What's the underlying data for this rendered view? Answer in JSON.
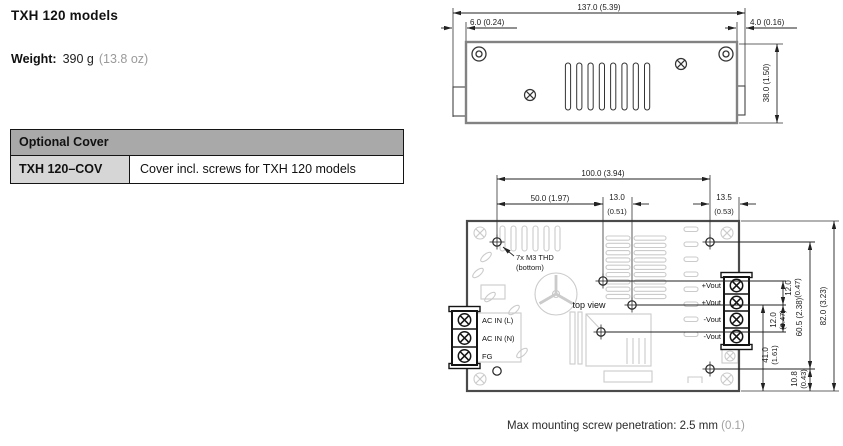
{
  "page": {
    "title": "TXH 120 models"
  },
  "weight": {
    "label": "Weight:",
    "grams": "390 g",
    "ounces": "(13.8 oz)"
  },
  "optional_cover_table": {
    "header": "Optional Cover",
    "row": {
      "model": "TXH 120–COV",
      "description": "Cover incl. screws for TXH 120 models"
    }
  },
  "side_view": {
    "dims": {
      "width_total": "137.0 (5.39)",
      "left_offset": "6.0 (0.24)",
      "right_offset": "4.0 (0.16)",
      "height": "38.0 (1.50)"
    }
  },
  "top_view": {
    "view_label": "top view",
    "thread_note_line1": "7x M3 THD",
    "thread_note_line2": "(bottom)",
    "dims": {
      "w100": "100.0 (3.94)",
      "w50": "50.0 (1.97)",
      "w13_mm": "13.0",
      "w13_in": "(0.51)",
      "w135_mm": "13.5",
      "w135_in": "(0.53)",
      "p12a_mm": "12.0",
      "p12a_in": "(0.47)",
      "p12b_mm": "12.0",
      "p12b_in": "(0.47)",
      "h605": "60.5 (2.38)",
      "h82": "82.0 (3.23)",
      "h41_mm": "41.0",
      "h41_in": "(1.61)",
      "h108_mm": "10.8",
      "h108_in": "(0.43)"
    },
    "terminals_input": [
      "AC IN (L)",
      "AC IN (N)",
      "FG"
    ],
    "terminals_output": [
      "+Vout",
      "+Vout",
      "-Vout",
      "-Vout"
    ]
  },
  "caption": {
    "metric": "Max mounting screw penetration: 2.5 mm",
    "imperial": "(0.1)"
  }
}
